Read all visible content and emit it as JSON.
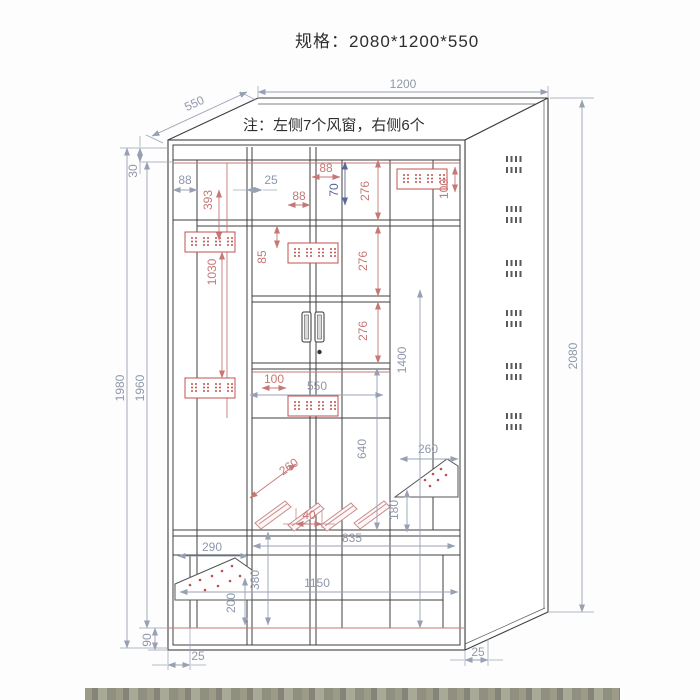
{
  "title": "规格：2080*1200*550",
  "note": "注：左侧7个风窗，右侧6个",
  "colors": {
    "drawing_line": "#3f3f3f",
    "dimension_gray": "#98a0b4",
    "dimension_red": "#c57876",
    "dimension_dark_blue": "#5a6899",
    "paper": "#ffffff"
  },
  "overall_size": {
    "height": "2080",
    "width": "1200",
    "depth": "550"
  },
  "vent_counts": {
    "left": "7",
    "right": "6"
  },
  "dims": {
    "depth": "550",
    "width": "1200",
    "height": "2080",
    "left_outer": "1980",
    "left_inner": "1960",
    "top_inset": "30",
    "left_col": "88",
    "left_vent_drop": "393",
    "door_gap": "25",
    "mid_col": "88",
    "mid_top_col": "88",
    "top_rail": "70",
    "top_shelf": "276",
    "right_vent_inset": "100",
    "vent_offset_mid": "85",
    "upper_shelf": "276",
    "left_vent_span": "1030",
    "mid_shelf": "276",
    "lower_span": "1400",
    "vent_inset_mid": "100",
    "cupboard_w": "550",
    "lower_gap": "640",
    "bracket_len": "260",
    "shelf_w": "260",
    "shelf_drop": "180",
    "bracket_gap": "40",
    "bottom_w": "835",
    "left_shelf_w": "290",
    "bottom_section": "380",
    "inner_w": "1150",
    "shelf_h": "200",
    "base_h": "90",
    "foot_inset_l": "25",
    "foot_inset_r": "25"
  }
}
